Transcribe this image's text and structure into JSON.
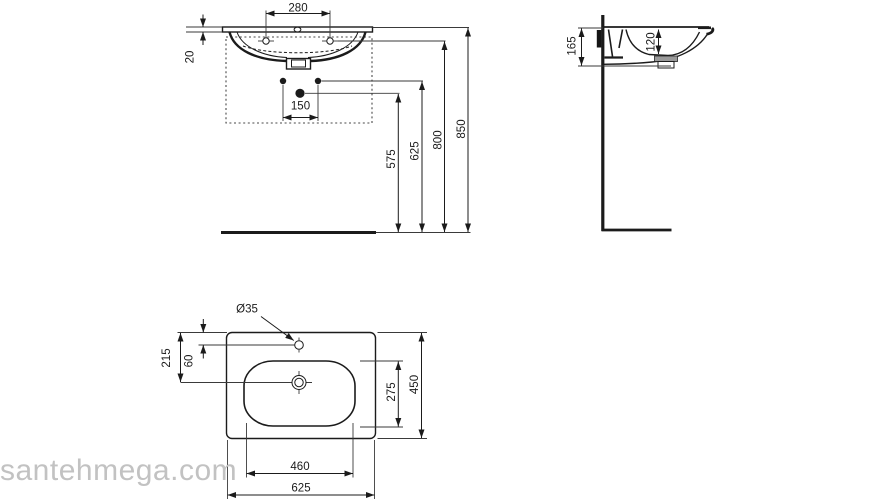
{
  "watermark": {
    "text": "santehmega.com"
  },
  "colors": {
    "background": "#ffffff",
    "line": "#1b1b1b",
    "watermark": "#c2c2c2"
  },
  "views": {
    "front_view": {
      "dimensions": {
        "faucet_holes_spacing": "280",
        "rim_thickness": "20",
        "supply_spacing": "150",
        "waste_outlet_height": "575",
        "supply_height": "625",
        "fixing_holes_height": "800",
        "rim_height": "850"
      }
    },
    "side_view": {
      "dimensions": {
        "basin_height": "165",
        "bowl_depth": "120"
      }
    },
    "plan_view": {
      "dimensions": {
        "tap_hole_diameter": "Ø35",
        "rear_to_drain": "215",
        "rear_to_tap": "60",
        "bowl_front_back": "275",
        "overall_depth": "450",
        "bowl_width": "460",
        "overall_width": "625"
      }
    }
  }
}
